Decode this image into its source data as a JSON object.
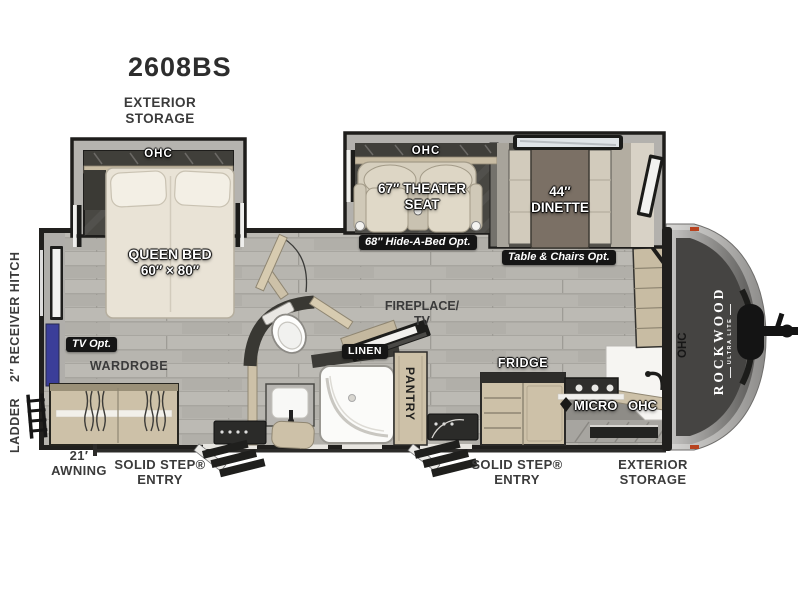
{
  "model": "2608BS",
  "colors": {
    "wall": "#1f1e1c",
    "floor": "#b7b5af",
    "slide_interior": "#494843",
    "cabinet_tan": "#cdc1a8",
    "badge_black": "#151515",
    "tv_mount_blue": "#3b3e99",
    "cap_silver": "#b7b6b4"
  },
  "exterior": {
    "storage_rear": "EXTERIOR STORAGE",
    "storage_front": "EXTERIOR STORAGE",
    "receiver_hitch": "2″ RECEIVER HITCH",
    "ladder": "LADDER",
    "awning": "21′ AWNING",
    "entry_rear": "SOLID STEP® ENTRY",
    "entry_front": "SOLID STEP® ENTRY",
    "brand": "ROCKWOOD",
    "brand_sub": "ULTRA LITE"
  },
  "bedroom": {
    "ohc": "OHC",
    "bed_name": "QUEEN BED",
    "bed_size": "60″ × 80″",
    "tv_opt": "TV Opt.",
    "wardrobe": "WARDROBE"
  },
  "living": {
    "ohc": "OHC",
    "theater_line1": "67″ THEATER",
    "theater_line2": "SEAT",
    "hide_a_bed_opt": "68″ Hide-A-Bed Opt.",
    "dinette_size": "44″",
    "dinette_name": "DINETTE",
    "table_chairs_opt": "Table & Chairs Opt.",
    "fireplace_line1": "FIREPLACE/",
    "fireplace_line2": "TV"
  },
  "bath": {
    "linen": "LINEN",
    "pantry": "PANTRY"
  },
  "kitchen": {
    "fridge": "FRIDGE",
    "micro": "MICRO",
    "ohc": "OHC",
    "ohc_front": "OHC"
  }
}
